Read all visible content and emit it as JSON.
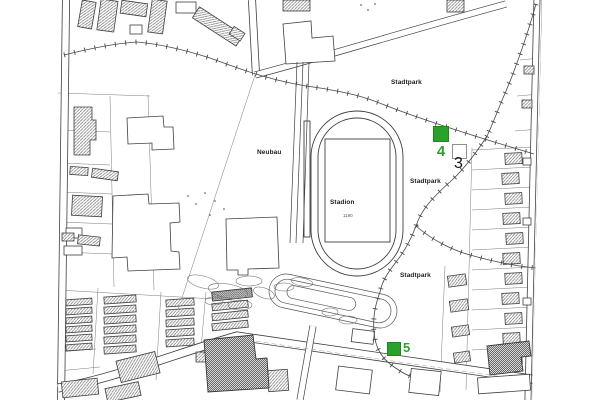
{
  "map": {
    "type": "cadastral-city-map",
    "labels": {
      "stadtpark_top": "Stadtpark",
      "stadtpark_mid": "Stadtpark",
      "stadtpark_bottom": "Stadtpark",
      "stadion": "Stadion",
      "neubau": "Neubau",
      "stadion_parcel_number": "1190"
    },
    "markers": [
      {
        "id": "4",
        "label": "4",
        "style": "filled-square",
        "color": "#2CA02C",
        "label_color": "#2CA02C"
      },
      {
        "id": "3",
        "label": "3",
        "style": "outline-square",
        "color": "#FFFFFF",
        "label_color": "#141414"
      },
      {
        "id": "5",
        "label": "5",
        "style": "filled-square",
        "color": "#2CA02C",
        "label_color": "#2CA02C"
      }
    ],
    "colors": {
      "background": "#FFFFFF",
      "linework": "#3D3D3D",
      "marker_green": "#2CA02C"
    }
  }
}
